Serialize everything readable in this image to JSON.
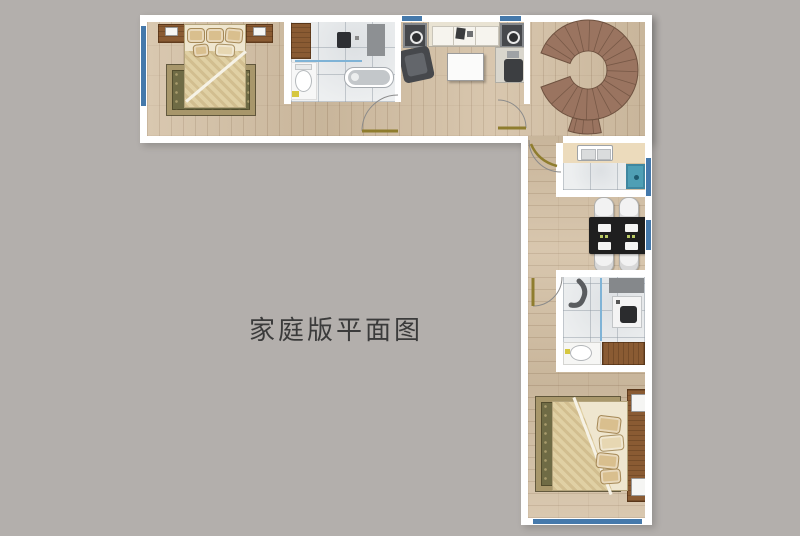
{
  "title": "家庭版平面图",
  "palette": {
    "background": "#b3afac",
    "wall": "#ffffff",
    "window_blue": "#4579ab",
    "wood_floor": "#d3bfa3",
    "tile": "#edeff0",
    "cabinet_brown": "#8a5b33",
    "stair_brown": "#9a7460",
    "stair_line": "#6f5240",
    "rug_olive": "#6f6b45",
    "rug_border": "#a8976b",
    "bed_cream": "#efe6cf",
    "blanket_tan": "#e0d0a4",
    "pillow_tan": "#d9bf8e",
    "table_black": "#1f1f1f",
    "chair_white": "#f2f2f2",
    "appliance_teal": "#4f9fb5",
    "counter_cream": "#ecdbbc",
    "door_leaf_gold": "#8f7d2e",
    "door_arc_gray": "#8a8a8a",
    "glass_blue": "#7fb3d6",
    "furniture_gray": "#46484c",
    "fixture_gray": "#8d9093",
    "title_color": "#3b3b3b"
  }
}
